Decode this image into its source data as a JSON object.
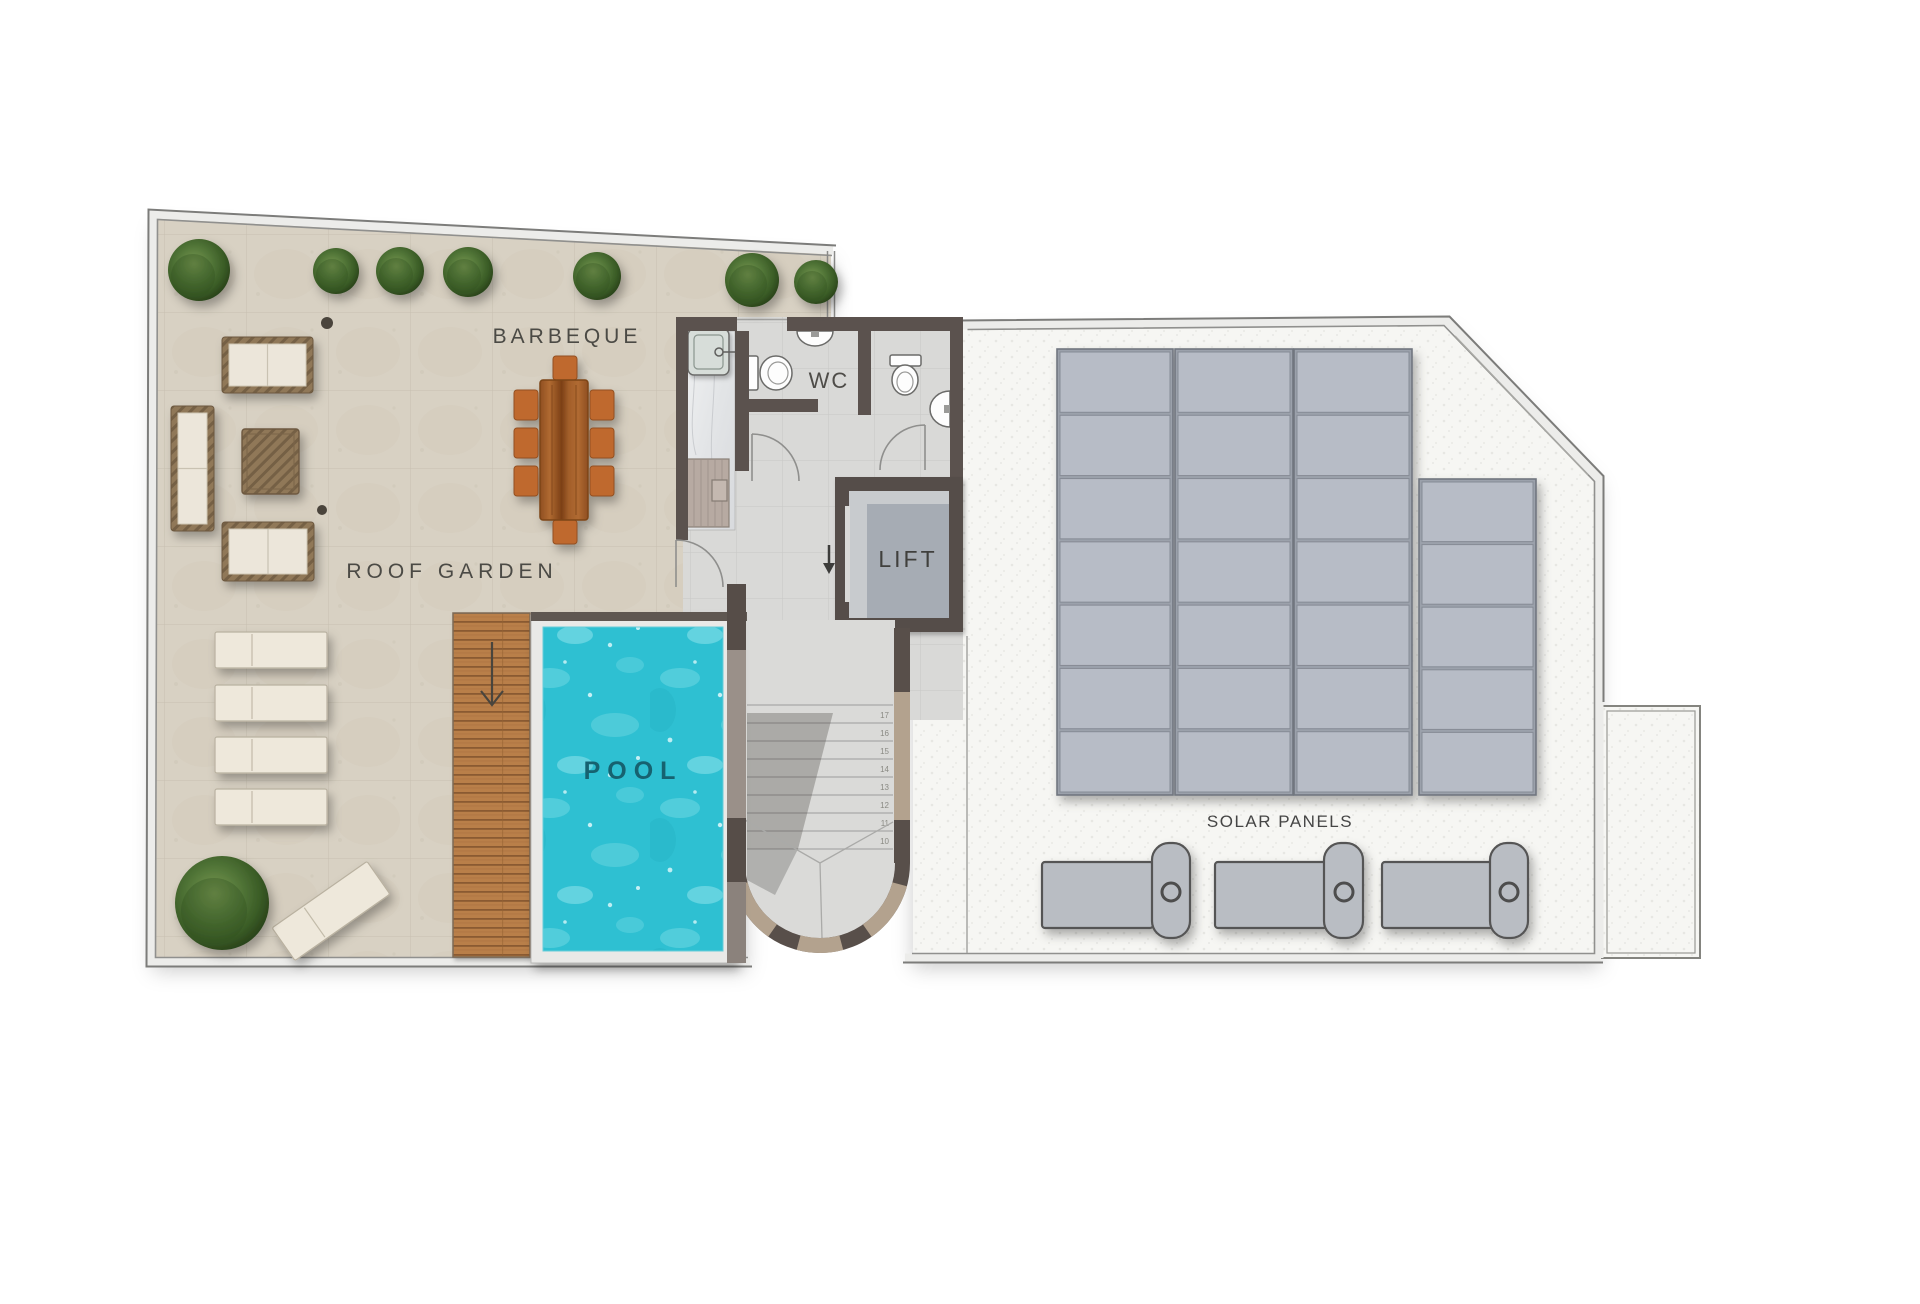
{
  "page": {
    "background": "#ffffff",
    "width": 1920,
    "height": 1304
  },
  "plan": {
    "labels": {
      "barbeque": "BARBEQUE",
      "roof_garden": "ROOF GARDEN",
      "pool": "POOL",
      "wc": "WC",
      "lift": "LIFT",
      "solar_panels": "SOLAR PANELS"
    },
    "stairs": {
      "step_numbers": [
        "17",
        "16",
        "15",
        "14",
        "13",
        "12",
        "11",
        "10"
      ],
      "tread_count": 9,
      "direction_arrow": "down"
    },
    "solar_array": {
      "panel_color": "#b7bcc6",
      "panel_border": "#868b95",
      "frame_color": "#9ba1ab",
      "gap": 3,
      "columns": [
        {
          "x": 1060,
          "y": 352,
          "w": 110,
          "h": 440,
          "panels": 7
        },
        {
          "x": 1178,
          "y": 352,
          "w": 112,
          "h": 440,
          "panels": 7
        },
        {
          "x": 1297,
          "y": 352,
          "w": 112,
          "h": 440,
          "panels": 7
        },
        {
          "x": 1422,
          "y": 482,
          "w": 111,
          "h": 310,
          "panels": 5
        }
      ]
    },
    "equipment": {
      "ac_units": 3
    },
    "vegetation": {
      "top_row_trees": 7,
      "garden_trees": 1,
      "sun_loungers": 5
    },
    "colors": {
      "pool_water": "#2fc0d2",
      "paving": "#d8d1c3",
      "deck_wood": "#b97f4a",
      "wall_dark": "#5b524e",
      "wall_light": "#b3a28e",
      "marble": "#e9ebec",
      "right_roof": "#f6f6f3",
      "panel": "#b7bcc6",
      "cushion": "#ece6da",
      "wicker": "#8f7757",
      "chair_wood": "#bf692e",
      "tree_green": "#3c5c26",
      "label_text": "#4b4a45"
    }
  }
}
